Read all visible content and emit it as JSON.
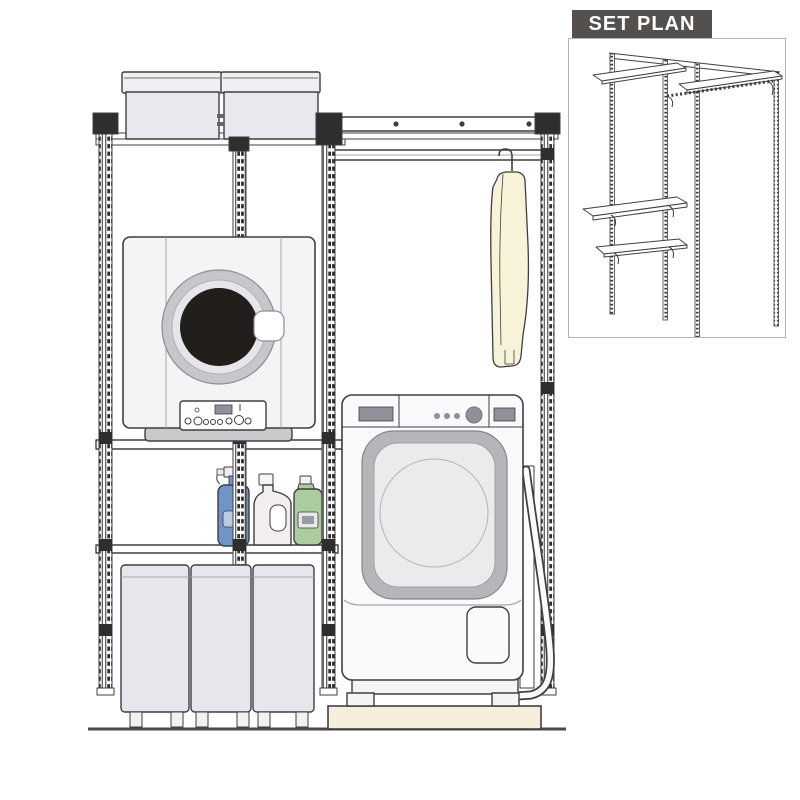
{
  "inset": {
    "title": "SET PLAN"
  },
  "illustration": {
    "components": [
      "wall-mounted slotted shelving rails",
      "top shelf with two lidded storage boxes",
      "hanger rod with hanging garment",
      "clothes dryer on mid shelf",
      "detergent shelf with spray bottle, detergent bottle and softener bottle",
      "three storage cabinets on floor",
      "front-loading drum washing machine on drain pan with drain hose"
    ]
  },
  "colors": {
    "outline": "#3f3f3f",
    "rail_dark": "#2e2e2e",
    "box_fill": "#e8e8ee",
    "box_lid": "#f0f0f4",
    "appliance_white": "#f4f4f7",
    "washer_white": "#fafafc",
    "ring_outer": "#c6c6cb",
    "ring_mid": "#e6e6ea",
    "drum": "#211e1c",
    "base_gray": "#c9c9ce",
    "door_ring": "#b5b5ba",
    "washer_glass": "#ebebee",
    "panel_dark": "#90909a",
    "pan_cream": "#f4eeda",
    "garment": "#f6f3d9",
    "bottle_blue": "#6e95c6",
    "bottle_blue_label": "#b9cce3",
    "bottle_white": "#f2eeee",
    "bottle_green": "#abcd9d",
    "cabinet_fill": "#e6e6ec",
    "floor": "#4a4a4a",
    "banner_bg": "#53504d",
    "banner_text": "#ffffff",
    "inset_border": "#b3b3b3"
  }
}
